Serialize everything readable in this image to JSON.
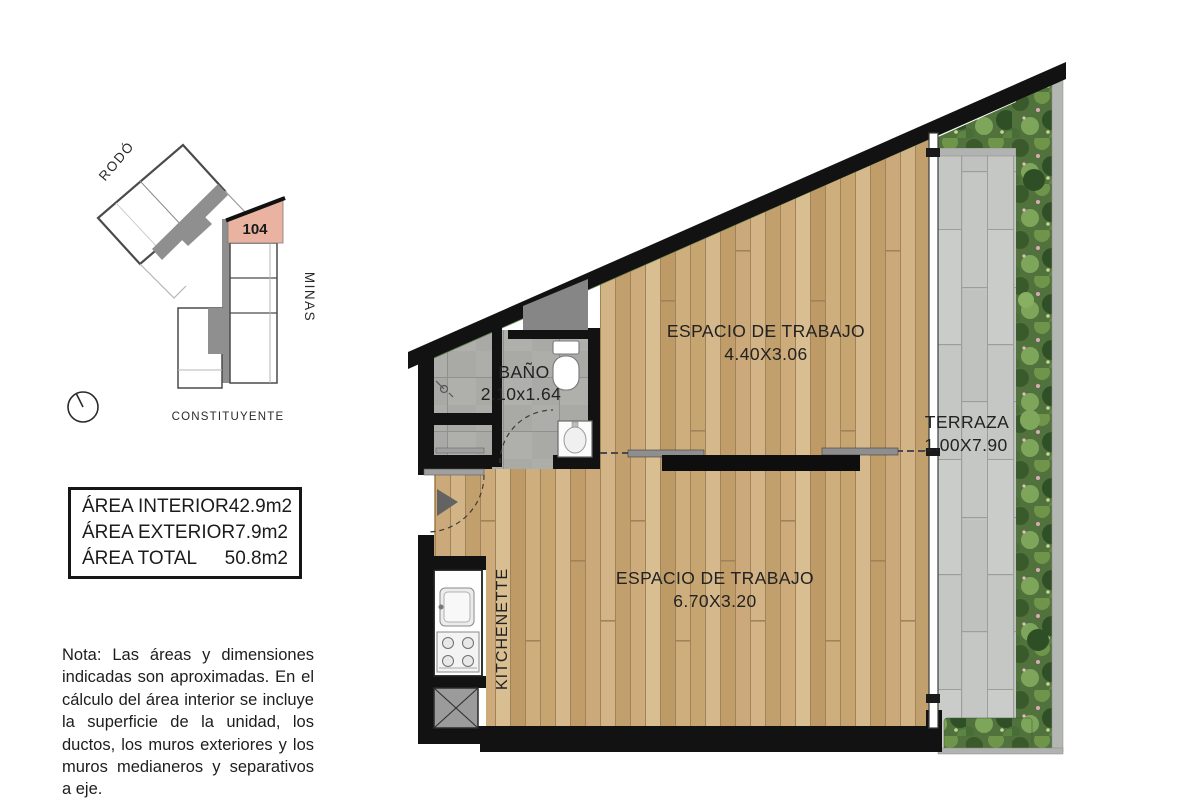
{
  "locator": {
    "streets": {
      "top": "RODÓ",
      "right": "MINAS",
      "bottom": "CONSTITUYENTE"
    },
    "unit_number": "104",
    "highlight_color": "#eab3a1"
  },
  "area_table": {
    "rows": [
      {
        "label": "ÁREA INTERIOR",
        "value": "42.9m2"
      },
      {
        "label": "ÁREA EXTERIOR",
        "value": "7.9m2"
      },
      {
        "label": "ÁREA TOTAL",
        "value": "50.8m2"
      }
    ]
  },
  "note": {
    "text": "Nota: Las áreas y dimensiones indicadas son aproximadas. En el cálculo del área interior se incluye la superficie de la unidad, los ductos, los muros exteriores y los muros medianeros y separativos a eje."
  },
  "plan": {
    "rooms": {
      "workspace_upper": {
        "name": "ESPACIO DE TRABAJO",
        "dims": "4.40X3.06"
      },
      "workspace_main": {
        "name": "ESPACIO DE TRABAJO",
        "dims": "6.70X3.20"
      },
      "bathroom": {
        "name": "BAÑO",
        "dims": "2.10x1.64"
      },
      "terrace": {
        "name": "TERRAZA",
        "dims": "1.00X7.90"
      },
      "kitchenette": {
        "name": "KITCHENETTE"
      }
    },
    "colors": {
      "wall": "#121212",
      "wood": "#c9a876",
      "bath_tile": "#a9a9a6",
      "terrace_paver": "#c5c7c4",
      "plants": "#51713d",
      "unit_highlight": "#eab3a1"
    }
  }
}
